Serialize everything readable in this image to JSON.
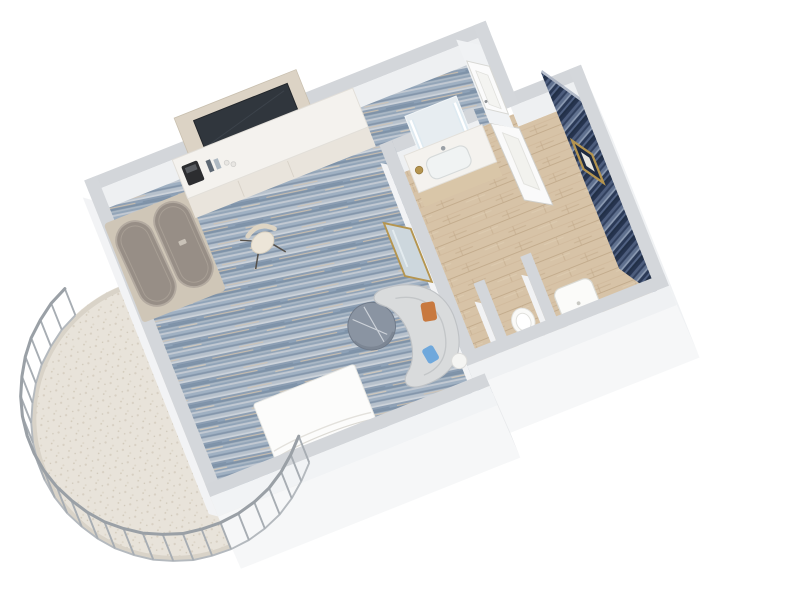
{
  "scene": {
    "type": "3d-floor-plan-render",
    "description": "Isometric cutaway render of a hotel guest room: carpeted bedroom, tiled bathroom with shower accent wall, entry hall and round wire-railed balcony",
    "rooms": [
      {
        "name": "bedroom",
        "floor": "blue mottled carpet"
      },
      {
        "name": "entry-hall",
        "floor": "blue mottled carpet"
      },
      {
        "name": "bathroom",
        "floor": "beige travertine tile"
      },
      {
        "name": "shower",
        "feature": "navy striped tile accent wall with gold framed niche"
      },
      {
        "name": "balcony",
        "floor": "speckled stone",
        "railing": "round vertical-bar wire railing"
      }
    ],
    "furniture": [
      "wardrobe with two sliding doors",
      "minibar counter with coffee machine and bottles",
      "wall wood panel with mounted tv",
      "long work desk",
      "desk chair",
      "gold leaning mirror",
      "curved lounge sofa with orange and blue cushions",
      "round side table",
      "small white side table",
      "white platform bed",
      "vanity with basin and led mirror",
      "gold tumbler",
      "open bathroom door",
      "shower tray",
      "toilet",
      "entry door"
    ]
  },
  "colors": {
    "page_bg": "#ffffff",
    "carpet_base": "#8fa3b8",
    "tile_base": "#d7c3a7",
    "accent_base": "#33415f",
    "balcony_floor": "#e8e3da",
    "wall_top": "#d3d6da",
    "wall_face": "#eef0f2",
    "slab_face": "#f6f7f8",
    "bed": "#fcfcfb",
    "sofa": "#d9dbdc",
    "pillow_orange": "#c8793f",
    "pillow_blue": "#6fa8dc",
    "table": "#8a94a2",
    "tv": "#30363d",
    "wood_panel": "#dcd3c5",
    "closet_door": "#978e86",
    "closet_frame": "#cfc6b7",
    "vanity_wood": "#d9c6a8",
    "gold": "#b5954f",
    "white_fixture": "#fafaf8",
    "railing": "#a7adb3",
    "counter": "#f4f2ee"
  }
}
